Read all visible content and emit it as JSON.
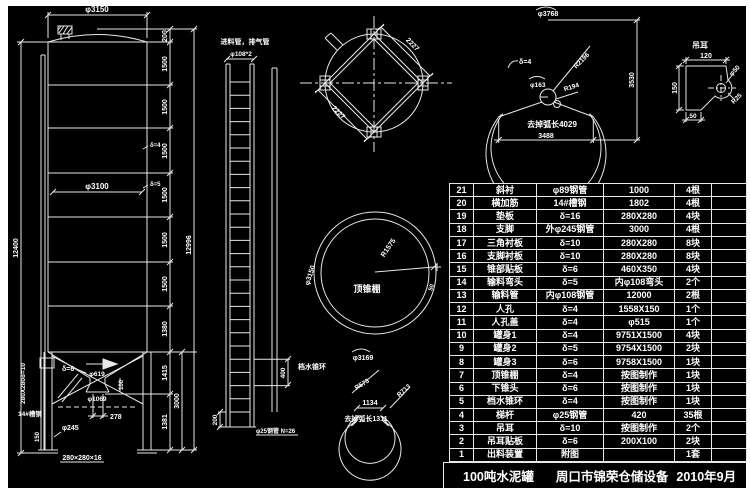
{
  "title_block": {
    "product": "100吨水泥罐",
    "company": "周口市锦荣仓储设备",
    "date": "2010年9月"
  },
  "parts_table": {
    "rows": [
      [
        "21",
        "斜衬",
        "φ89钢管",
        "1000",
        "4根"
      ],
      [
        "20",
        "横加筋",
        "14#槽钢",
        "1802",
        "4根"
      ],
      [
        "19",
        "垫板",
        "δ=16",
        "280X280",
        "4块"
      ],
      [
        "18",
        "支脚",
        "外φ245钢管",
        "3000",
        "4根"
      ],
      [
        "17",
        "三角衬板",
        "δ=10",
        "280X280",
        "8块"
      ],
      [
        "16",
        "支脚衬板",
        "δ=10",
        "280X280",
        "8块"
      ],
      [
        "15",
        "锥部贴板",
        "δ=6",
        "460X350",
        "4块"
      ],
      [
        "14",
        "输料弯头",
        "δ=5",
        "内φ108弯头",
        "2个"
      ],
      [
        "13",
        "输料管",
        "内φ108钢管",
        "12000",
        "2根"
      ],
      [
        "12",
        "人孔",
        "δ=4",
        "1558X150",
        "1个"
      ],
      [
        "11",
        "人孔盖",
        "δ=4",
        "φ515",
        "1个"
      ],
      [
        "10",
        "罐身1",
        "δ=4",
        "9751X1500",
        "4块"
      ],
      [
        "9",
        "罐身2",
        "δ=5",
        "9754X1500",
        "2块"
      ],
      [
        "8",
        "罐身3",
        "δ=6",
        "9758X1500",
        "1块"
      ],
      [
        "7",
        "顶锥棚",
        "δ=4",
        "按图制作",
        "1块"
      ],
      [
        "6",
        "下锥头",
        "δ=6",
        "按图制作",
        "1块"
      ],
      [
        "5",
        "档水锥环",
        "δ=4",
        "按图制作",
        "1块"
      ],
      [
        "4",
        "梯杆",
        "φ25钢管",
        "420",
        "35根"
      ],
      [
        "3",
        "吊耳",
        "δ=10",
        "按图制作",
        "2个"
      ],
      [
        "2",
        "吊耳贴板",
        "δ=6",
        "200X100",
        "2块"
      ],
      [
        "1",
        "出料装置",
        "附图",
        "",
        "1套"
      ]
    ]
  },
  "drawing": {
    "elevation": {
      "dia_top": "φ3150",
      "dia_body": "φ3100",
      "height_left": "12400",
      "height_total": "12996",
      "segments": [
        "200",
        "1500",
        "1500",
        "1500",
        "1500",
        "1500",
        "1500",
        "1380"
      ],
      "t4": "δ=4",
      "t5": "δ=5",
      "t6": "δ=6",
      "outlet_top": "φ619",
      "outlet_bottom": "φ1069",
      "outlet_h": "100",
      "cone_h": "1415",
      "leg_h": "3000",
      "lower_h": "1381",
      "offset": "278",
      "leg_dia": "φ245",
      "foot_h": "150",
      "base_plate": "280×280×16",
      "pad_note": "280X280δ=10",
      "channel": "14#槽钢"
    },
    "ladder": {
      "title": "进料管，排气管",
      "pipe": "φ108*2",
      "bottom": "200",
      "spacing": "400",
      "rungs": "φ25钢管 N=26"
    },
    "plan": {
      "side1": "2227",
      "side2": "2227"
    },
    "development": {
      "arc_dia": "φ3768",
      "thk": "δ=4",
      "hub_dia": "φ163",
      "r1": "R194",
      "r2": "R2196",
      "cut": "去掉弧长4029",
      "width": "3488",
      "height": "3530"
    },
    "roof_cone": {
      "label": "顶锥棚",
      "radius": "R1575",
      "arc_dia": "φ3150",
      "lap": "50"
    },
    "ring": {
      "label": "档水锥环",
      "arc_dia": "φ3169",
      "r1": "R573",
      "r2": "R713",
      "width": "1134",
      "cut": "去掉弧长1311"
    },
    "lug": {
      "label": "吊耳",
      "w": "120",
      "h": "150",
      "t": "50",
      "hole": "φ50",
      "r": "R25"
    }
  }
}
